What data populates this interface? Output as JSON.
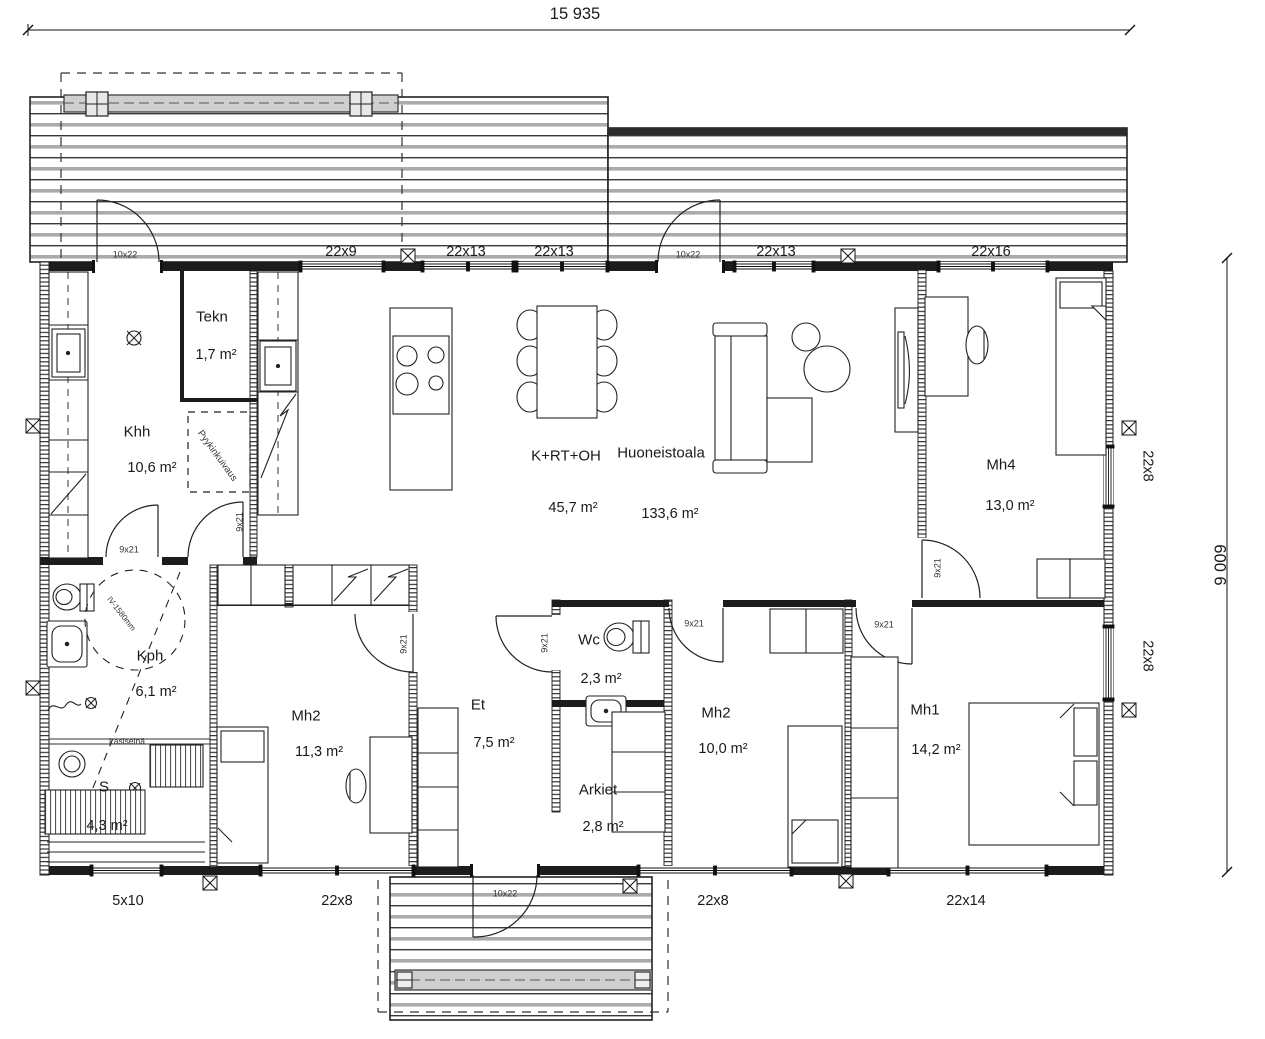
{
  "drawing": {
    "title": "floor-plan",
    "background": "#ffffff",
    "ink": "#1c1c1c"
  },
  "dimensions": {
    "total_width": {
      "text": "15 935",
      "x": 575,
      "y": 14,
      "fs": 16.5,
      "rot": 0
    },
    "total_height": {
      "text": "9 009",
      "x": 1221,
      "y": 565,
      "fs": 16.5,
      "rot": -90
    }
  },
  "rooms": [
    {
      "id": "tekn",
      "name": "Tekn",
      "area": "1,7 m²",
      "name_pos": {
        "x": 212,
        "y": 317
      },
      "area_pos": {
        "x": 216,
        "y": 355
      }
    },
    {
      "id": "khh",
      "name": "Khh",
      "area": "10,6 m²",
      "name_pos": {
        "x": 137,
        "y": 432
      },
      "area_pos": {
        "x": 152,
        "y": 468
      }
    },
    {
      "id": "krtoh",
      "name": "K+RT+OH",
      "area": "45,7 m²",
      "name_pos": {
        "x": 566,
        "y": 456
      },
      "area_pos": {
        "x": 573,
        "y": 508
      }
    },
    {
      "id": "total",
      "name": "Huoneistoala",
      "area": "133,6 m²",
      "name_pos": {
        "x": 661,
        "y": 453
      },
      "area_pos": {
        "x": 670,
        "y": 514
      }
    },
    {
      "id": "mh4",
      "name": "Mh4",
      "area": "13,0 m²",
      "name_pos": {
        "x": 1001,
        "y": 465
      },
      "area_pos": {
        "x": 1010,
        "y": 506
      }
    },
    {
      "id": "kph",
      "name": "Kph",
      "area": "6,1 m²",
      "name_pos": {
        "x": 150,
        "y": 656
      },
      "area_pos": {
        "x": 156,
        "y": 692
      }
    },
    {
      "id": "s",
      "name": "S",
      "area": "4,3 m²",
      "name_pos": {
        "x": 104,
        "y": 787
      },
      "area_pos": {
        "x": 107,
        "y": 826
      }
    },
    {
      "id": "mh2a",
      "name": "Mh2",
      "area": "11,3 m²",
      "name_pos": {
        "x": 306,
        "y": 716
      },
      "area_pos": {
        "x": 319,
        "y": 752
      }
    },
    {
      "id": "et",
      "name": "Et",
      "area": "7,5 m²",
      "name_pos": {
        "x": 478,
        "y": 705
      },
      "area_pos": {
        "x": 494,
        "y": 743
      }
    },
    {
      "id": "wc",
      "name": "Wc",
      "area": "2,3 m²",
      "name_pos": {
        "x": 589,
        "y": 640
      },
      "area_pos": {
        "x": 601,
        "y": 679
      }
    },
    {
      "id": "arkiet",
      "name": "Arkiet",
      "area": "2,8 m²",
      "name_pos": {
        "x": 598,
        "y": 790
      },
      "area_pos": {
        "x": 603,
        "y": 827
      }
    },
    {
      "id": "mh2b",
      "name": "Mh2",
      "area": "10,0 m²",
      "name_pos": {
        "x": 716,
        "y": 713
      },
      "area_pos": {
        "x": 723,
        "y": 749
      }
    },
    {
      "id": "mh1",
      "name": "Mh1",
      "area": "14,2 m²",
      "name_pos": {
        "x": 925,
        "y": 710
      },
      "area_pos": {
        "x": 936,
        "y": 750
      }
    }
  ],
  "window_labels": [
    {
      "text": "22x9",
      "x": 341,
      "y": 252,
      "rot": 0
    },
    {
      "text": "22x13",
      "x": 466,
      "y": 252,
      "rot": 0
    },
    {
      "text": "22x13",
      "x": 554,
      "y": 252,
      "rot": 0
    },
    {
      "text": "22x13",
      "x": 776,
      "y": 252,
      "rot": 0
    },
    {
      "text": "22x16",
      "x": 991,
      "y": 252,
      "rot": 0
    },
    {
      "text": "5x10",
      "x": 128,
      "y": 901,
      "rot": 0
    },
    {
      "text": "22x8",
      "x": 337,
      "y": 901,
      "rot": 0
    },
    {
      "text": "22x8",
      "x": 713,
      "y": 901,
      "rot": 0
    },
    {
      "text": "22x14",
      "x": 966,
      "y": 901,
      "rot": 0
    },
    {
      "text": "22x8",
      "x": 1147,
      "y": 466,
      "rot": 90
    },
    {
      "text": "22x8",
      "x": 1147,
      "y": 656,
      "rot": 90
    }
  ],
  "door_labels": [
    {
      "text": "10x22",
      "x": 125,
      "y": 255,
      "rot": 0
    },
    {
      "text": "10x22",
      "x": 688,
      "y": 255,
      "rot": 0
    },
    {
      "text": "10x22",
      "x": 505,
      "y": 894,
      "rot": 0
    },
    {
      "text": "9x21",
      "x": 129,
      "y": 550,
      "rot": 0
    },
    {
      "text": "9x21",
      "x": 240,
      "y": 522,
      "rot": -90
    },
    {
      "text": "9x21",
      "x": 404,
      "y": 644,
      "rot": -90
    },
    {
      "text": "9x21",
      "x": 545,
      "y": 643,
      "rot": -90
    },
    {
      "text": "9x21",
      "x": 694,
      "y": 624,
      "rot": 0
    },
    {
      "text": "9x21",
      "x": 884,
      "y": 625,
      "rot": 0
    },
    {
      "text": "9x21",
      "x": 938,
      "y": 568,
      "rot": -90
    }
  ],
  "annotations": [
    {
      "id": "laundry-drying",
      "text": "Pyykinkuivaus",
      "x": 217,
      "y": 456,
      "rot": 54,
      "fs": 9.5
    },
    {
      "id": "glass-wall",
      "text": "Lasiseinä",
      "x": 127,
      "y": 741,
      "rot": 0,
      "fs": 8.5
    },
    {
      "id": "iv-circle",
      "text": "IV-1580mm",
      "x": 121,
      "y": 614,
      "rot": 52,
      "fs": 8
    }
  ]
}
